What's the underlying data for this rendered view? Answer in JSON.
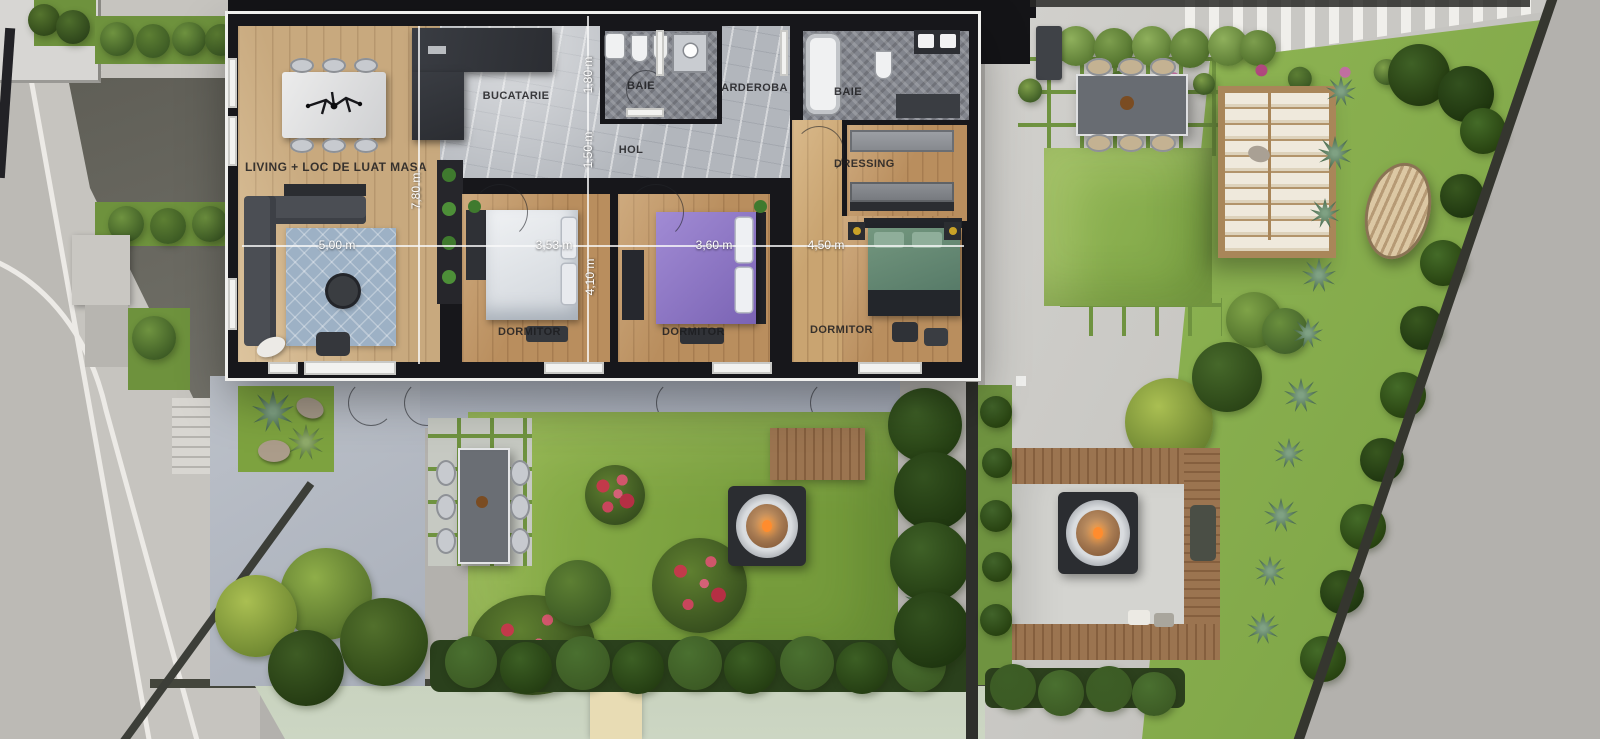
{
  "scene": {
    "type": "apartment-floor-plan-with-gardens",
    "view": "top-down 3D render"
  },
  "rooms": {
    "living": {
      "label": "LIVING + LOC DE LUAT MASA"
    },
    "bucatarie": {
      "label": "BUCATARIE"
    },
    "baie1": {
      "label": "BAIE"
    },
    "garderoba": {
      "label": "GARDEROBA"
    },
    "baie2": {
      "label": "BAIE"
    },
    "hol": {
      "label": "HOL"
    },
    "dressing": {
      "label": "DRESSING"
    },
    "dormitor1": {
      "label": "DORMITOR"
    },
    "dormitor2": {
      "label": "DORMITOR"
    },
    "dormitor3": {
      "label": "DORMITOR"
    }
  },
  "dimensions": {
    "d780": {
      "label": "7,80 m",
      "orientation": "vertical",
      "room": "living"
    },
    "d500": {
      "label": "5,00 m",
      "orientation": "horizontal",
      "room": "living"
    },
    "d180": {
      "label": "1,80 m",
      "orientation": "vertical",
      "room": "baie1"
    },
    "d150": {
      "label": "1,50 m",
      "orientation": "vertical",
      "room": "hol"
    },
    "d353": {
      "label": "3,53 m",
      "orientation": "horizontal",
      "room": "dormitor1"
    },
    "d410": {
      "label": "4,10 m",
      "orientation": "vertical",
      "room": "dormitor1"
    },
    "d360": {
      "label": "3,60 m",
      "orientation": "horizontal",
      "room": "dormitor2"
    },
    "d450": {
      "label": "4,50 m",
      "orientation": "horizontal",
      "room": "dormitor3"
    }
  },
  "palette": {
    "wall": "#17171b",
    "frame": "#f0f0ee",
    "woodLiving": "#c8a97e",
    "woodBedroom": "#b98e5e",
    "marble": "#b2b6bc",
    "bathTile": "#82858d",
    "terrace": "#aeb5c0",
    "grass": "#84aa47",
    "hedge": "#33511f",
    "concrete": "#cbcac5",
    "road": "#b3b1ad",
    "asphalt": "#68675f",
    "deck": "#9b7450",
    "roseBush": "#c23a4a",
    "bedPurple": "#8d76c4",
    "bedGreen": "#5d8370",
    "firePit": "#2b2d31",
    "copperBowl": "#b98a5e",
    "bottomBand": "#ccd5c2"
  }
}
